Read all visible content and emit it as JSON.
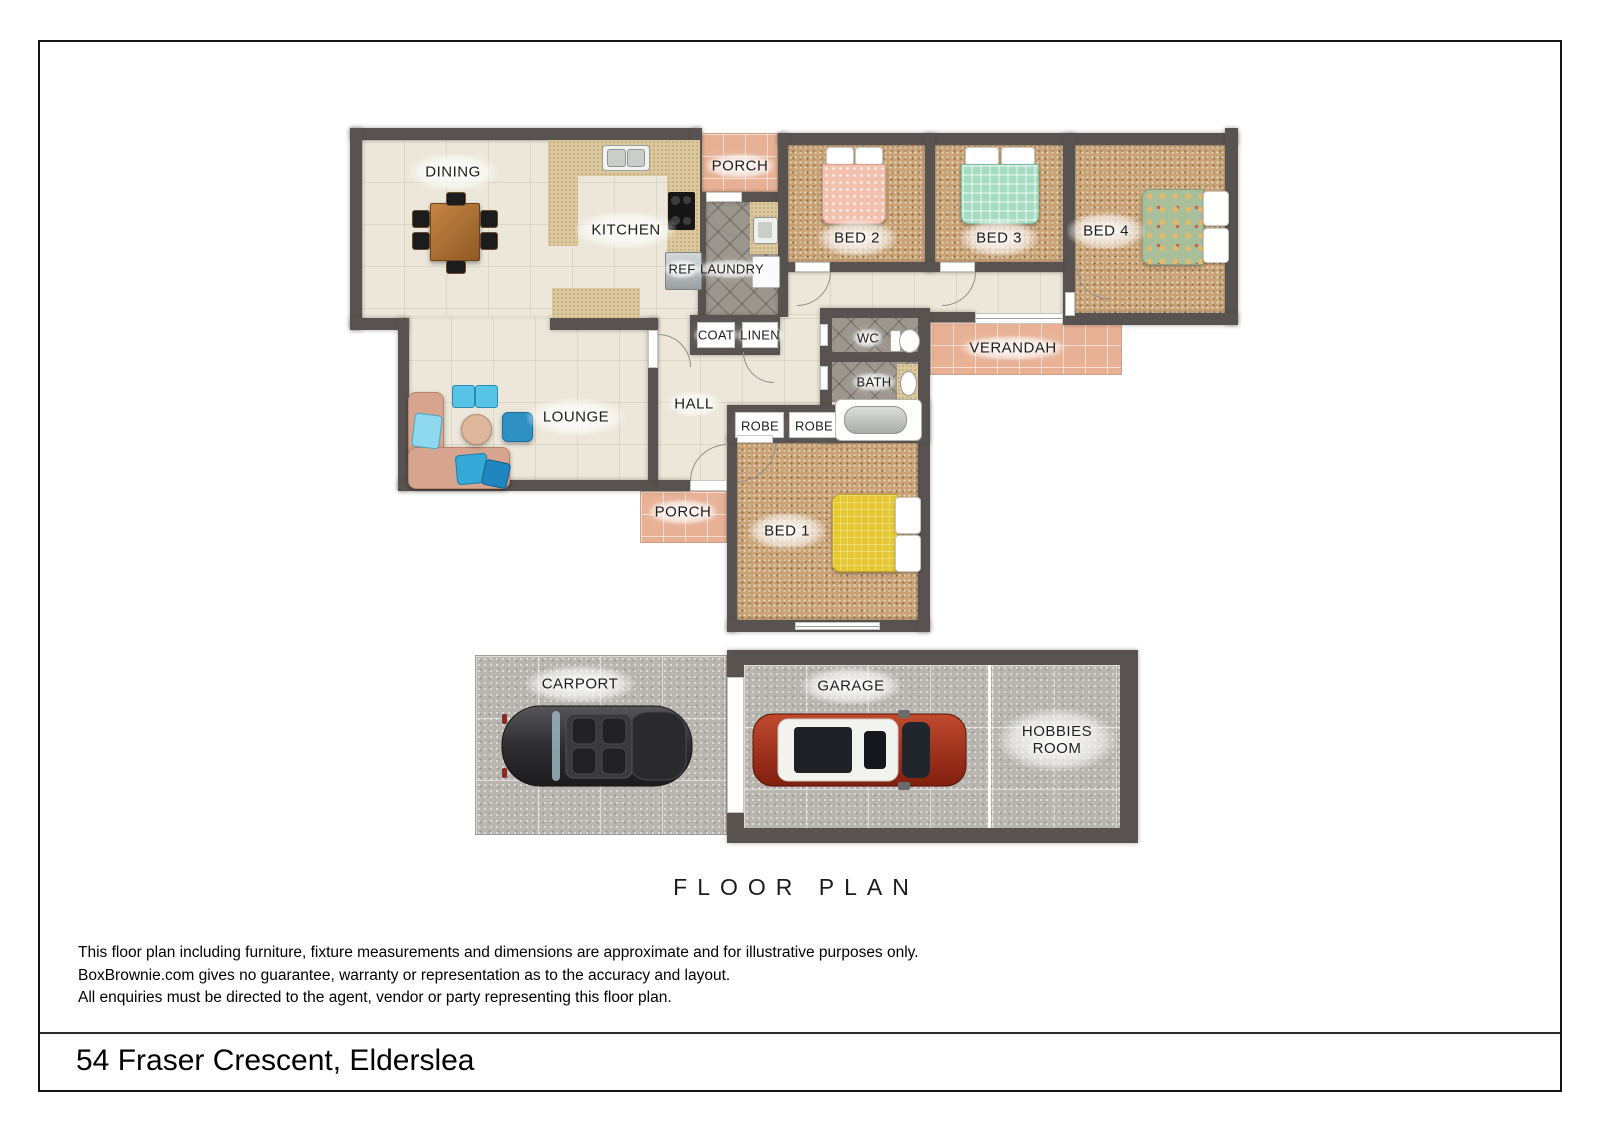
{
  "page": {
    "floor_plan_heading": "FLOOR PLAN",
    "address": "54 Fraser Crescent, Elderslea",
    "disclaimer": [
      "This floor plan including furniture, fixture measurements and dimensions are approximate and for illustrative purposes only.",
      "BoxBrownie.com gives no guarantee, warranty or representation as to the accuracy and layout.",
      "All enquiries must be directed to the agent, vendor or party representing this floor plan."
    ]
  },
  "rooms": {
    "dining": "DINING",
    "kitchen": "KITCHEN",
    "porch_top": "PORCH",
    "bed2": "BED 2",
    "bed3": "BED 3",
    "bed4": "BED 4",
    "ref": "REF",
    "laundry": "LAUNDRY",
    "coat": "COAT",
    "linen": "LINEN",
    "wc": "WC",
    "bath": "BATH",
    "verandah": "VERANDAH",
    "lounge": "LOUNGE",
    "hall": "HALL",
    "robe_left": "ROBE",
    "robe_right": "ROBE",
    "porch_bottom": "PORCH",
    "bed1": "BED 1",
    "carport": "CARPORT",
    "garage": "GARAGE",
    "hobbies": "HOBBIES ROOM"
  },
  "colors": {
    "wall": "#585350",
    "floor_cream": "#ece7da",
    "carpet": "#c9a376",
    "tile_pink": "#e8b195",
    "tile_gray": "#9c968e",
    "concrete": "#b9b6b1",
    "counter": "#dcc89f",
    "bed2_quilt": "#f3c2af",
    "bed3_quilt": "#a6dcc3",
    "bed4_quilt": "#a9bf9c",
    "bed1_quilt": "#e6c832",
    "sofa": "#d7a590",
    "cushion_blue": "#45b1de",
    "car_red": "#9e2f1e",
    "car_gray": "#3c3c3e"
  }
}
